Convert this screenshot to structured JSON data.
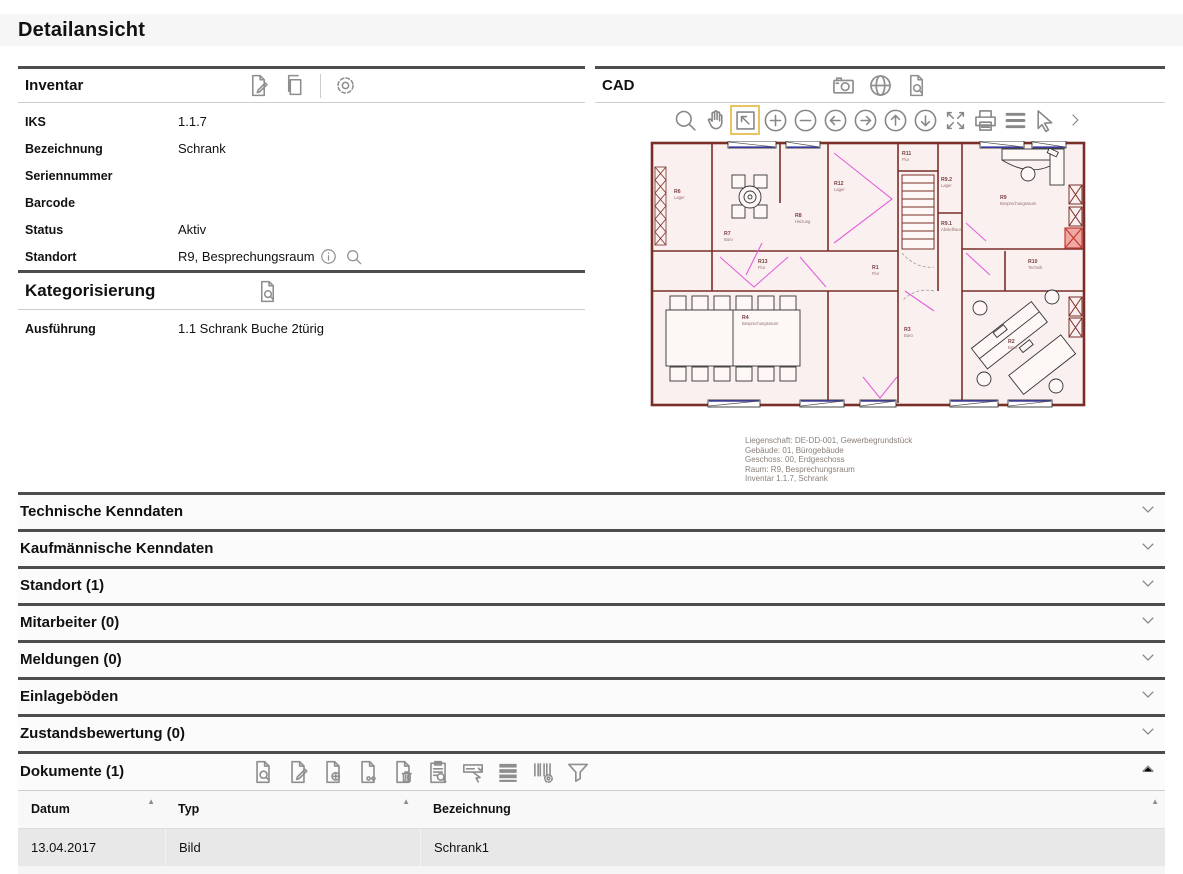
{
  "page": {
    "title": "Detailansicht"
  },
  "inventar": {
    "title": "Inventar",
    "toolbar_icons": [
      "edit-document-icon",
      "copy-document-icon",
      "settings-gear-icon"
    ],
    "fields": [
      {
        "label": "IKS",
        "value": "1.1.7"
      },
      {
        "label": "Bezeichnung",
        "value": "Schrank"
      },
      {
        "label": "Seriennummer",
        "value": ""
      },
      {
        "label": "Barcode",
        "value": ""
      },
      {
        "label": "Status",
        "value": "Aktiv"
      },
      {
        "label": "Standort",
        "value": "R9, Besprechungsraum"
      }
    ],
    "standort_icons": [
      "info-icon",
      "search-icon"
    ]
  },
  "kategorisierung": {
    "title": "Kategorisierung",
    "toolbar_icons": [
      "document-search-icon"
    ],
    "fields": [
      {
        "label": "Ausführung",
        "value": "1.1 Schrank Buche 2türig"
      }
    ]
  },
  "cad": {
    "title": "CAD",
    "header_icons": [
      "camera-icon",
      "globe-icon",
      "document-search-icon"
    ],
    "viewer_toolbar_icons": [
      "zoom-search",
      "pan-hand",
      "zoom-window",
      "zoom-in",
      "zoom-out",
      "pan-left",
      "pan-right",
      "pan-up",
      "pan-down",
      "zoom-fit",
      "print",
      "menu-lines",
      "select-pointer",
      "more-chevron"
    ],
    "active_tool": "zoom-window",
    "caption_lines": [
      "Liegenschaft: DE-DD-001, Gewerbegrundstück",
      "Gebäude: 01, Bürogebäude",
      "Geschoss: 00, Erdgeschoss",
      "Raum: R9, Besprechungsraum",
      "Inventar 1.1.7, Schrank"
    ],
    "plan": {
      "highlighted_item": "Schrank 1.1.7 (rot markiert)",
      "wall_color": "#7a2e28",
      "floor_color": "#faf0ef",
      "door_color": "#e060dd",
      "highlight_color": "#d94f42",
      "rooms": [
        {
          "id": "R6",
          "type": "Lager"
        },
        {
          "id": "R7",
          "type": "Büro"
        },
        {
          "id": "R8",
          "type": "Heizung"
        },
        {
          "id": "R12",
          "type": "Lager"
        },
        {
          "id": "R11",
          "type": "Flur"
        },
        {
          "id": "R9.2",
          "type": "Lager"
        },
        {
          "id": "R9",
          "type": "Besprechungsraum"
        },
        {
          "id": "R9.1",
          "type": "Abstellraum"
        },
        {
          "id": "R13",
          "type": "Flur"
        },
        {
          "id": "R1",
          "type": "Flur"
        },
        {
          "id": "R10",
          "type": "Technik"
        },
        {
          "id": "R4",
          "type": "Besprechungsraum"
        },
        {
          "id": "R3",
          "type": "Büro"
        },
        {
          "id": "R2",
          "type": "Büro"
        }
      ]
    }
  },
  "accordions": [
    {
      "label": "Technische Kenndaten"
    },
    {
      "label": "Kaufmännische Kenndaten"
    },
    {
      "label": "Standort (1)"
    },
    {
      "label": "Mitarbeiter (0)"
    },
    {
      "label": "Meldungen (0)"
    },
    {
      "label": "Einlageböden"
    },
    {
      "label": "Zustandsbewertung (0)"
    }
  ],
  "dokumente": {
    "title": "Dokumente (1)",
    "toolbar_icons": [
      "document-search-icon",
      "document-edit-icon",
      "document-add-icon",
      "document-link-icon",
      "document-delete-icon",
      "clipboard-search-icon",
      "select-dropdown-icon",
      "list-rows-icon",
      "barcode-settings-icon",
      "filter-funnel-icon"
    ],
    "table": {
      "columns": [
        {
          "label": "Datum",
          "sorted": "asc"
        },
        {
          "label": "Typ",
          "sorted": "asc"
        },
        {
          "label": "Bezeichnung",
          "sorted": ""
        }
      ],
      "rows": [
        {
          "datum": "13.04.2017",
          "typ": "Bild",
          "bezeichnung": "Schrank1"
        }
      ]
    }
  }
}
